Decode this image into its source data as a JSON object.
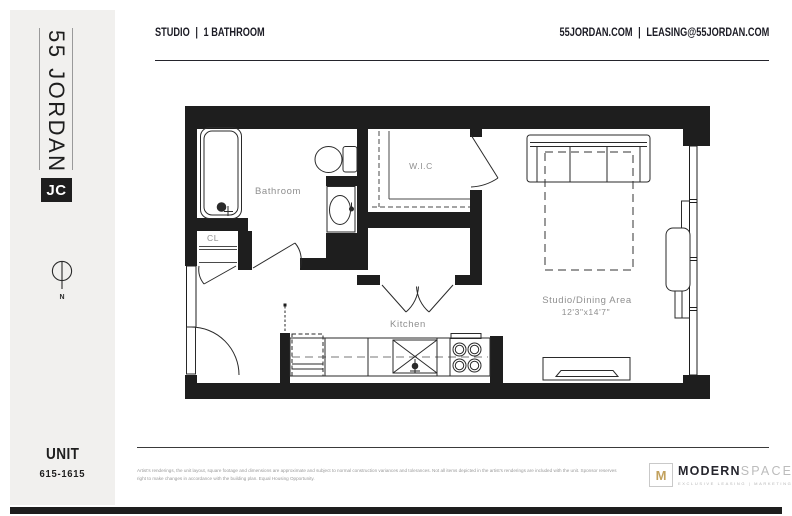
{
  "colors": {
    "wall": "#1e1e1e",
    "sidebar_bg": "#f1f0ee",
    "label_gray": "#8f8f8f",
    "gold": "#c2a15d",
    "dark_text": "#1b1b24"
  },
  "sidebar": {
    "logo_vertical": "55 JORDAN",
    "logo_badge": "JC",
    "compass_label": "N",
    "unit_label": "UNIT",
    "unit_number": "615-1615"
  },
  "header": {
    "left": {
      "unit_type": "STUDIO",
      "separator": "|",
      "bathrooms": "1 BATHROOM"
    },
    "right": {
      "website": "55JORDAN.COM",
      "separator": "|",
      "email": "LEASING@55JORDAN.COM"
    }
  },
  "floorplan": {
    "labels": {
      "bathroom": "Bathroom",
      "closet": "CL",
      "wic": "W.I.C",
      "kitchen": "Kitchen",
      "studio": "Studio/Dining Area",
      "studio_dimensions": "12'3\"x14'7\""
    }
  },
  "footer": {
    "disclaimer": "Artist's renderings, the unit layout, square footage and dimensions are approximate and subject to normal construction variances and tolerances. Not all items depicted in the artist's renderings are included with the unit. Sponsor reserves right to make changes in accordance with the building plan. Equal Housing Opportunity.",
    "logo": {
      "mark": "M",
      "name_bold": "MODERN",
      "name_light": "SPACES",
      "tagline": "EXCLUSIVE LEASING | MARKETING"
    }
  }
}
